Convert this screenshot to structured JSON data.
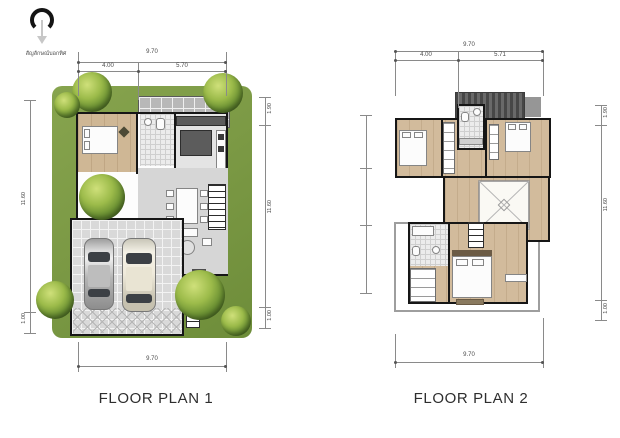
{
  "sheet": {
    "background": "#ffffff"
  },
  "north": {
    "caption": "สัญลักษณ์บอกทิศ"
  },
  "plan1": {
    "title": "FLOOR PLAN 1",
    "dim_top_total": "9.70",
    "dim_top_left": "4.00",
    "dim_top_right": "5.70",
    "dim_bottom_total": "9.70",
    "dim_left_main": "11.60",
    "dim_left_bottom": "1.00",
    "dim_right_top": "1.90",
    "dim_right_main": "11.60",
    "dim_right_bottom": "1.00"
  },
  "plan2": {
    "title": "FLOOR PLAN 2",
    "dim_top_total": "9.70",
    "dim_top_left": "4.00",
    "dim_top_right": "5.71",
    "dim_bottom_total": "9.70",
    "dim_right_top": "1.90",
    "dim_right_main": "11.60",
    "dim_right_bottom": "1.00"
  },
  "colors": {
    "grass": "#74923e",
    "tree_light": "#b8d45e",
    "tree_dark": "#3f6321",
    "wood": "#cdb592",
    "tile": "#d9d9d9",
    "counter": "#5c5c5c",
    "roof": "#565656",
    "wall": "#161616",
    "dim_line": "#8a8a8a",
    "text": "#2e2e2e"
  }
}
